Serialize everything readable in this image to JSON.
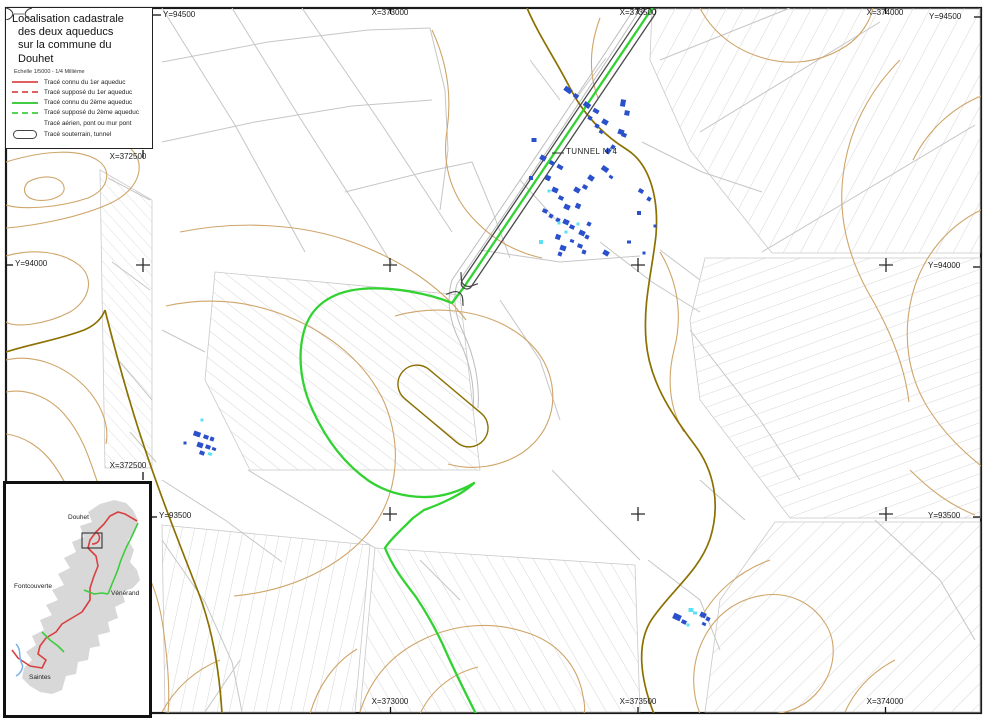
{
  "title_block": {
    "line1": "Localisation cadastrale",
    "line2": "des deux aqueducs",
    "line3": "sur la commune du",
    "line4": "Douhet",
    "scale_note": "Echelle 1/5000 - 1/4 Millième"
  },
  "legend": {
    "items": [
      {
        "label": "Tracé connu du 1er aqueduc",
        "symbol": "line-solid",
        "color": "#e05f5f"
      },
      {
        "label": "Tracé supposé du 1er aqueduc",
        "symbol": "line-dashed",
        "color": "#e05f5f"
      },
      {
        "label": "Tracé connu du 2ème aqueduc",
        "symbol": "line-solid",
        "color": "#44cc44"
      },
      {
        "label": "Tracé supposé du 2ème aqueduc",
        "symbol": "line-dashed",
        "color": "#55d455"
      },
      {
        "label": "Tracé aérien, pont ou mur pont",
        "symbol": "bridge",
        "color": "#444444"
      },
      {
        "label": "Tracé souterrain, tunnel",
        "symbol": "tunnel",
        "color": "#444444"
      }
    ]
  },
  "map_labels": {
    "tunnel": "TUNNEL N°4"
  },
  "coords": {
    "top_y_left": "Y=94500",
    "top_x1": "X=373000",
    "top_x2": "X=373500",
    "top_x3": "X=374000",
    "top_y_right": "Y=94500",
    "left_y1": "Y=94000",
    "left_x_upper": "X=372500",
    "left_x_lower": "X=372500",
    "left_y2": "Y=93500",
    "right_y1": "Y=94000",
    "right_y2": "Y=93500",
    "bottom_x1": "X=373000",
    "bottom_x2": "X=373500",
    "bottom_x3": "X=374000"
  },
  "inset": {
    "commune_top": "Douhet",
    "commune_left": "Fontcouverte",
    "commune_right": "Vénérand",
    "commune_bottom": "Saintes"
  },
  "colors": {
    "aqueduct1_red": "#e05f5f",
    "aqueduct2_green": "#32d232",
    "building_blue": "#2a50cc",
    "building_cyan": "#5ce1f2",
    "contour_light": "#cfa569",
    "contour_dark": "#8b7000",
    "parcel_gray": "#c9c9c9",
    "frame_black": "#1a1a1a"
  }
}
